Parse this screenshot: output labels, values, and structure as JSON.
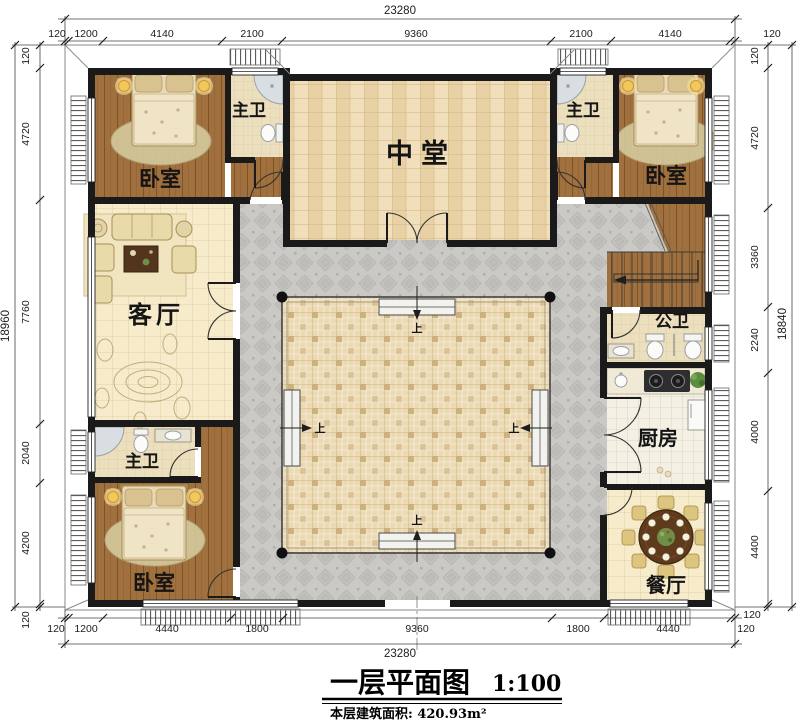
{
  "title": {
    "name": "一层平面图",
    "scale": "1:100",
    "area": "本层建筑面积: 420.93m²"
  },
  "rooms": {
    "bedroom_top_left": "卧室",
    "bath_top_left": "主卫",
    "hall": "中堂",
    "bath_top_right": "主卫",
    "bedroom_top_right": "卧室",
    "living": "客厅",
    "public_bath": "公卫",
    "kitchen": "厨房",
    "bath_bottom_left": "主卫",
    "bedroom_bottom_left": "卧室",
    "dining": "餐厅",
    "step": "上"
  },
  "dims": {
    "top_total": "23280",
    "top": [
      "120",
      "1200",
      "4140",
      "2100",
      "9360",
      "2100",
      "4140",
      "120"
    ],
    "bottom": [
      "120",
      "1200",
      "4440",
      "1800",
      "9360",
      "1800",
      "4440",
      "120"
    ],
    "bottom_total": "23280",
    "left": [
      "120",
      "4720",
      "7760",
      "2040",
      "4200",
      "120"
    ],
    "left_total": "18960",
    "right": [
      "120",
      "4720",
      "3360",
      "2240",
      "4000",
      "4400",
      "120"
    ],
    "right_total": "18840"
  },
  "colors": {
    "wall": "#1a1a1a",
    "wood_floor": "#a0703e",
    "tile_light": "#f6ebca",
    "hall_tile": "#f1debb",
    "bath_tile": "#ecdfbd",
    "kitchen_tile": "#f4f1e4",
    "walkway": "#cbc9c5",
    "courtyard": "#ead9b3",
    "lamp": "#f2c85c",
    "table_wood": "#5e3b1d",
    "plant": "#5d8c3e"
  }
}
